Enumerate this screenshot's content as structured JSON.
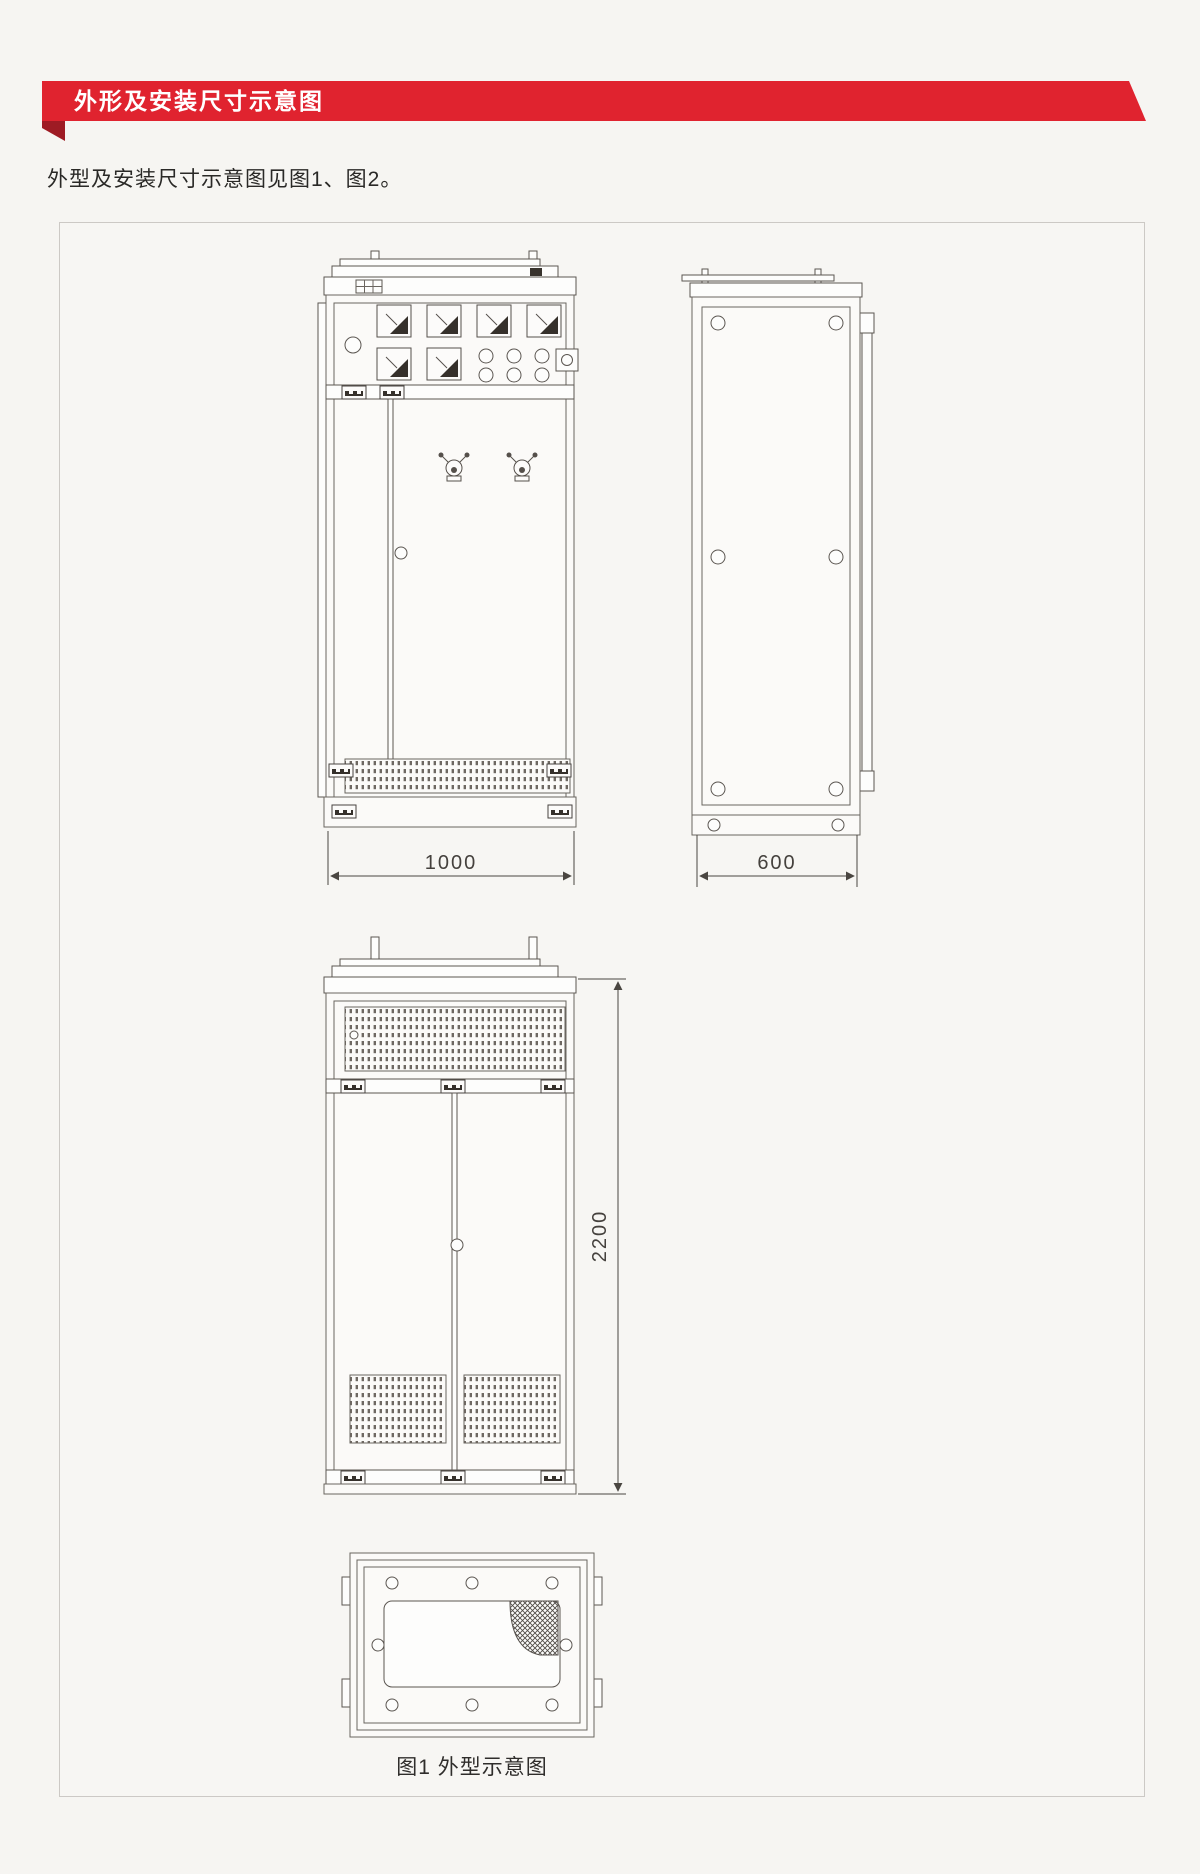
{
  "page": {
    "background": "#f6f5f2",
    "accent_red": "#e0232f",
    "accent_red_dark": "#9e1b24",
    "line_color": "#6a655f"
  },
  "header": {
    "title": "外形及安装尺寸示意图"
  },
  "intro": {
    "text": "外型及安装尺寸示意图见图1、图2。"
  },
  "figure": {
    "caption": "图1 外型示意图",
    "dimensions": {
      "front_width": "1000",
      "side_depth": "600",
      "cabinet_height": "2200"
    }
  }
}
